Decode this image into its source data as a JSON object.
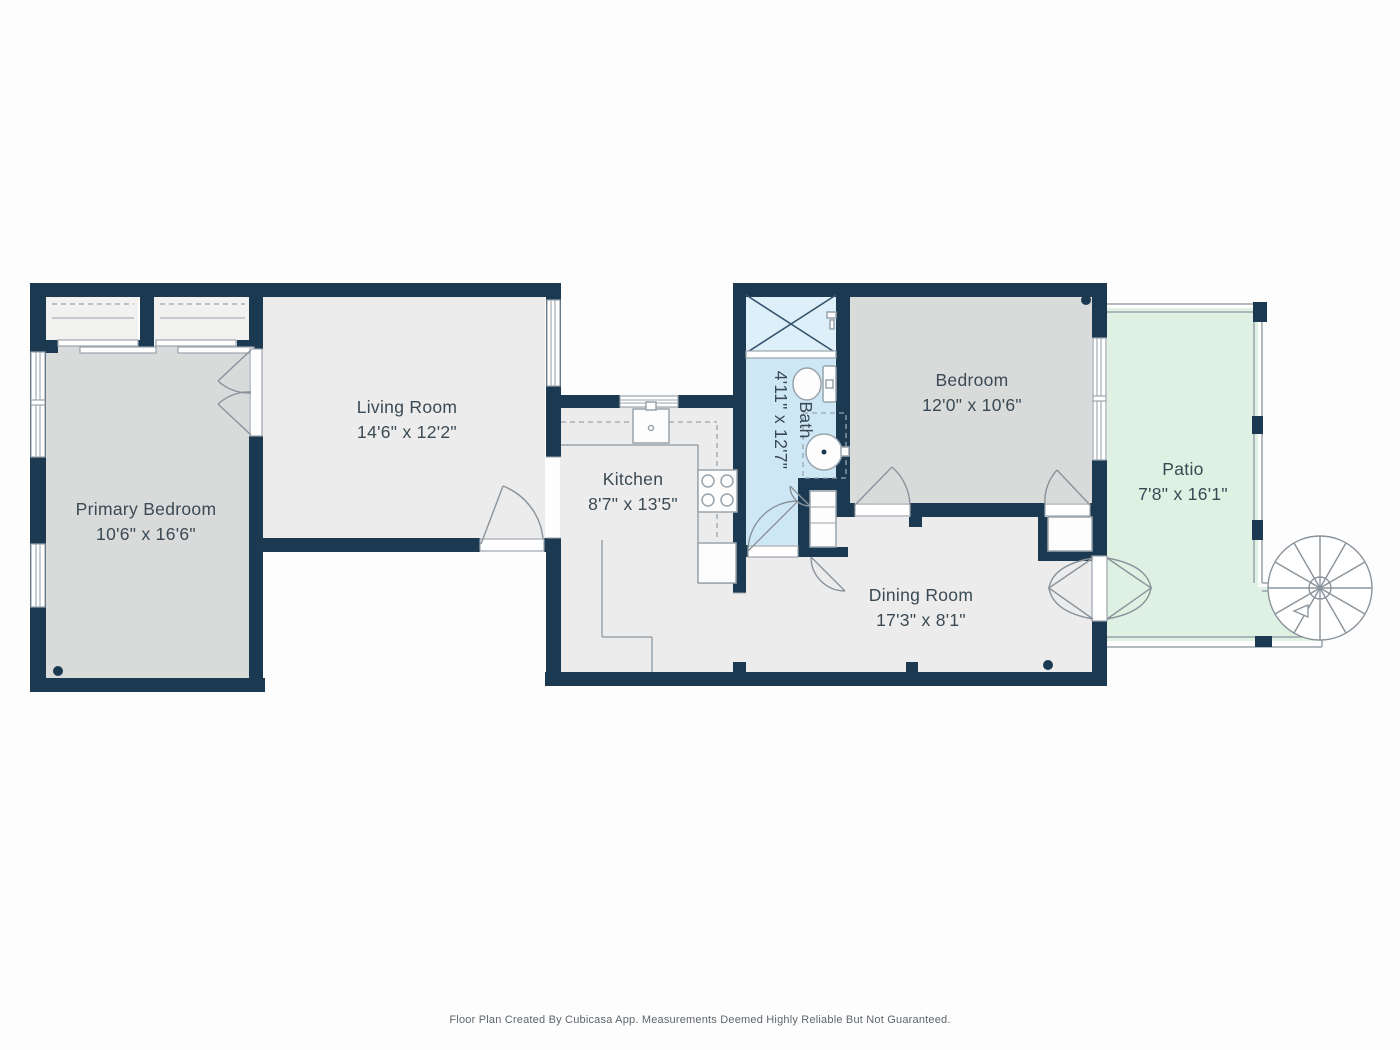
{
  "colors": {
    "wall": "#1b3a52",
    "room_light": "#ececec",
    "room_gray": "#d9dada",
    "bath": "#cee7f5",
    "shower": "#ddeff9",
    "patio": "#dff1e2",
    "closet": "#f1f1f0",
    "line": "#9aa4ac",
    "text": "#3a4a55"
  },
  "rooms": [
    {
      "id": "primary-bedroom",
      "name": "Primary Bedroom",
      "dims": "10'6\" x 16'6\""
    },
    {
      "id": "living-room",
      "name": "Living Room",
      "dims": "14'6\" x 12'2\""
    },
    {
      "id": "kitchen",
      "name": "Kitchen",
      "dims": "8'7\" x 13'5\""
    },
    {
      "id": "bath",
      "name": "Bath",
      "dims": "4'11\" x 12'7\""
    },
    {
      "id": "bedroom",
      "name": "Bedroom",
      "dims": "12'0\" x 10'6\""
    },
    {
      "id": "dining-room",
      "name": "Dining Room",
      "dims": "17'3\" x 8'1\""
    },
    {
      "id": "patio",
      "name": "Patio",
      "dims": "7'8\" x 16'1\""
    }
  ],
  "footer": {
    "text": "Floor Plan Created By Cubicasa App. Measurements Deemed Highly Reliable But Not Guaranteed."
  }
}
